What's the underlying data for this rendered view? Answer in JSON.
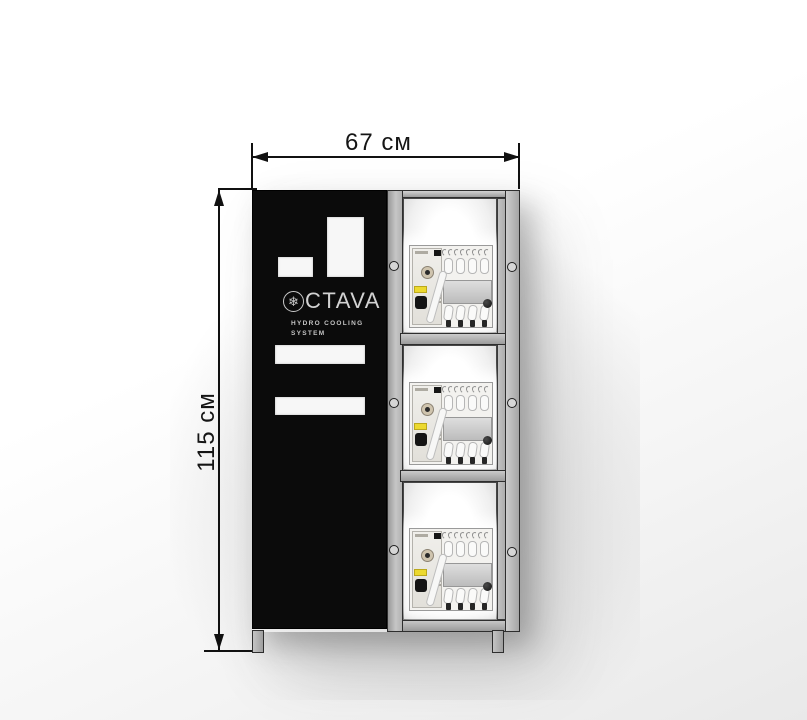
{
  "dimensions": {
    "width_label": "67 см",
    "height_label": "115 см"
  },
  "branding": {
    "logo_text": "CTAVA",
    "subtitle_line1": "HYDRO  COOLING",
    "subtitle_line2": "SYSTEM"
  },
  "icons": {
    "snowflake": "❄"
  },
  "colors": {
    "panel_black": "#0b0b0b",
    "frame_gray": "#b3b3b3",
    "unit_label_yellow": "#ecd92f",
    "dimension_ink": "#111111"
  }
}
